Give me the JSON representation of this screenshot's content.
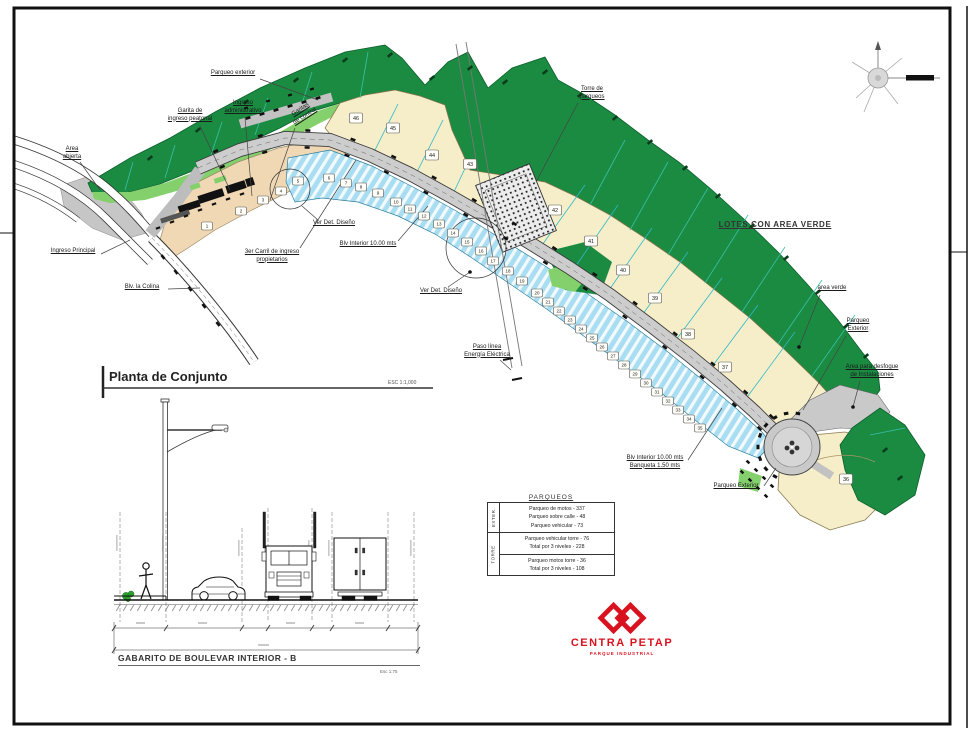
{
  "titles": {
    "plan_title": "Planta de Conjunto",
    "plan_scale": "ESC 1:1,000",
    "section_title": "GABARITO DE BOULEVAR INTERIOR - B",
    "section_scale": "Esc 1:75"
  },
  "logo": {
    "name": "CENTRA PETAP",
    "tagline": "PARQUE INDUSTRIAL",
    "color": "#d9121f"
  },
  "parking_table": {
    "title": "PARQUEOS",
    "ext_label": "EXTER.",
    "torre_label": "TORRE",
    "ext_rows": [
      "Parqueo de motos - 337",
      "Parqueo sobre calle - 48",
      "Parqueo vehicular - 73"
    ],
    "torre_rows_1": [
      "Parqueo vehicular torre - 76",
      "Total por 3 niveles - 228"
    ],
    "torre_rows_2": [
      "Parqueo motos torre - 36",
      "Total por 3 niveles - 108"
    ]
  },
  "map": {
    "colors": {
      "green": "#1b8b42",
      "light_green": "#84d06d",
      "cream": "#f6eec9",
      "peach": "#f1d8b4",
      "blue": "#a9def2",
      "road": "#cdcdcd",
      "accent_red": "#d9121f"
    },
    "callouts": [
      {
        "id": "parqueo-exterior-top",
        "text": "Parqueo exterior",
        "x": 233,
        "y": 70,
        "leader": [
          260,
          79,
          318,
          100
        ]
      },
      {
        "id": "garita-ingreso-peatonal",
        "text": "Garita de\ningreso peatonal",
        "x": 190,
        "y": 108,
        "leader": [
          200,
          126,
          230,
          190
        ]
      },
      {
        "id": "ingreso-administrativo",
        "text": "Ingreso\nadministrativo",
        "x": 243,
        "y": 100,
        "leader": [
          245,
          118,
          252,
          196
        ]
      },
      {
        "id": "garitas-de-control",
        "text": "Garitas\nde control",
        "x": 303,
        "y": 106,
        "rot": -33,
        "leader": [
          295,
          128,
          270,
          200
        ]
      },
      {
        "id": "area-abierta",
        "text": "Area\nabierta",
        "x": 72,
        "y": 146,
        "leader": [
          80,
          162,
          100,
          190
        ]
      },
      {
        "id": "ingreso-principal",
        "text": "Ingreso Principal",
        "x": 73,
        "y": 248,
        "leader": [
          101,
          254,
          130,
          240
        ]
      },
      {
        "id": "tercer-carril",
        "text": "3er Carril de ingreso\npropietarios",
        "x": 272,
        "y": 249,
        "leader": [
          300,
          248,
          356,
          160
        ]
      },
      {
        "id": "blv-la-colina",
        "text": "Blv. la Colina",
        "x": 142,
        "y": 284,
        "leader": [
          168,
          289,
          200,
          288
        ]
      },
      {
        "id": "ver-det-diseno-1",
        "text": "Ver Det. Diseño",
        "x": 334,
        "y": 220,
        "leader": [
          318,
          220,
          302,
          206
        ]
      },
      {
        "id": "blv-interior-1",
        "text": "Blv Interior 10.00 mts",
        "x": 368,
        "y": 241,
        "leader": [
          398,
          241,
          428,
          206
        ]
      },
      {
        "id": "ver-det-diseno-2",
        "text": "Ver Det. Diseño",
        "x": 441,
        "y": 288,
        "leader": [
          448,
          287,
          470,
          272
        ],
        "dot": true
      },
      {
        "id": "paso-linea",
        "text": "Paso línea\nEnergía Eléctrica",
        "x": 487,
        "y": 344,
        "leader": [
          500,
          360,
          511,
          370
        ]
      },
      {
        "id": "torre-de-parqueos",
        "text": "Torre de\nparqueos",
        "x": 592,
        "y": 86,
        "leader": [
          578,
          103,
          536,
          182
        ]
      },
      {
        "id": "lotes-con-area-verde",
        "text": "LOTES CON AREA VERDE",
        "x": 775,
        "y": 220,
        "big": true
      },
      {
        "id": "area-verde",
        "text": "area verde",
        "x": 832,
        "y": 285,
        "leader": [
          820,
          295,
          799,
          347
        ],
        "dot": true
      },
      {
        "id": "parqueo-exterior-right",
        "text": "Parqueo\nExterior",
        "x": 858,
        "y": 318,
        "leader": [
          846,
          336,
          803,
          410
        ]
      },
      {
        "id": "area-desfogue",
        "text": "Area para desfogue\nde Instalaciones",
        "x": 872,
        "y": 364,
        "leader": [
          860,
          381,
          853,
          407
        ],
        "dot": true
      },
      {
        "id": "blv-interior-2",
        "text": "Blv Interior 10.00 mts\nBanqueta 1.50 mts",
        "x": 655,
        "y": 455,
        "leader": [
          688,
          460,
          722,
          408
        ]
      },
      {
        "id": "parqueo-exterior-bottom",
        "text": "Parqueo Exterior",
        "x": 736,
        "y": 483,
        "leader": [
          764,
          486,
          776,
          468
        ]
      }
    ],
    "peach_lots": [
      {
        "n": "1",
        "x": 207,
        "y": 226
      },
      {
        "n": "2",
        "x": 241,
        "y": 211
      },
      {
        "n": "3",
        "x": 263,
        "y": 200
      },
      {
        "n": "4",
        "x": 281,
        "y": 191
      }
    ],
    "small_lots": [
      {
        "n": "5",
        "x": 298,
        "y": 181
      },
      {
        "n": "6",
        "x": 329,
        "y": 178
      },
      {
        "n": "7",
        "x": 346,
        "y": 183
      },
      {
        "n": "8",
        "x": 361,
        "y": 187
      },
      {
        "n": "9",
        "x": 378,
        "y": 193
      },
      {
        "n": "10",
        "x": 396,
        "y": 202
      },
      {
        "n": "11",
        "x": 410,
        "y": 209
      },
      {
        "n": "12",
        "x": 424,
        "y": 216
      },
      {
        "n": "13",
        "x": 439,
        "y": 224
      },
      {
        "n": "14",
        "x": 453,
        "y": 233
      },
      {
        "n": "15",
        "x": 467,
        "y": 242
      },
      {
        "n": "16",
        "x": 481,
        "y": 251
      },
      {
        "n": "17",
        "x": 493,
        "y": 261
      },
      {
        "n": "18",
        "x": 508,
        "y": 271
      },
      {
        "n": "19",
        "x": 522,
        "y": 281
      },
      {
        "n": "20",
        "x": 537,
        "y": 293
      },
      {
        "n": "21",
        "x": 548,
        "y": 302
      },
      {
        "n": "22",
        "x": 559,
        "y": 311
      },
      {
        "n": "23",
        "x": 570,
        "y": 320
      },
      {
        "n": "24",
        "x": 581,
        "y": 329
      },
      {
        "n": "25",
        "x": 592,
        "y": 338
      },
      {
        "n": "26",
        "x": 602,
        "y": 347
      },
      {
        "n": "27",
        "x": 613,
        "y": 356
      },
      {
        "n": "28",
        "x": 624,
        "y": 365
      },
      {
        "n": "29",
        "x": 635,
        "y": 374
      },
      {
        "n": "30",
        "x": 646,
        "y": 383
      },
      {
        "n": "31",
        "x": 657,
        "y": 392
      },
      {
        "n": "32",
        "x": 668,
        "y": 401
      },
      {
        "n": "33",
        "x": 678,
        "y": 410
      },
      {
        "n": "34",
        "x": 689,
        "y": 419
      },
      {
        "n": "35",
        "x": 700,
        "y": 428
      }
    ],
    "large_lots": [
      {
        "n": "46",
        "x": 356,
        "y": 118
      },
      {
        "n": "45",
        "x": 393,
        "y": 128
      },
      {
        "n": "44",
        "x": 432,
        "y": 155
      },
      {
        "n": "43",
        "x": 470,
        "y": 164
      },
      {
        "n": "42",
        "x": 555,
        "y": 210
      },
      {
        "n": "41",
        "x": 591,
        "y": 241
      },
      {
        "n": "40",
        "x": 623,
        "y": 270
      },
      {
        "n": "39",
        "x": 655,
        "y": 298
      },
      {
        "n": "38",
        "x": 688,
        "y": 334
      },
      {
        "n": "37",
        "x": 725,
        "y": 367
      },
      {
        "n": "36",
        "x": 846,
        "y": 479
      }
    ]
  }
}
